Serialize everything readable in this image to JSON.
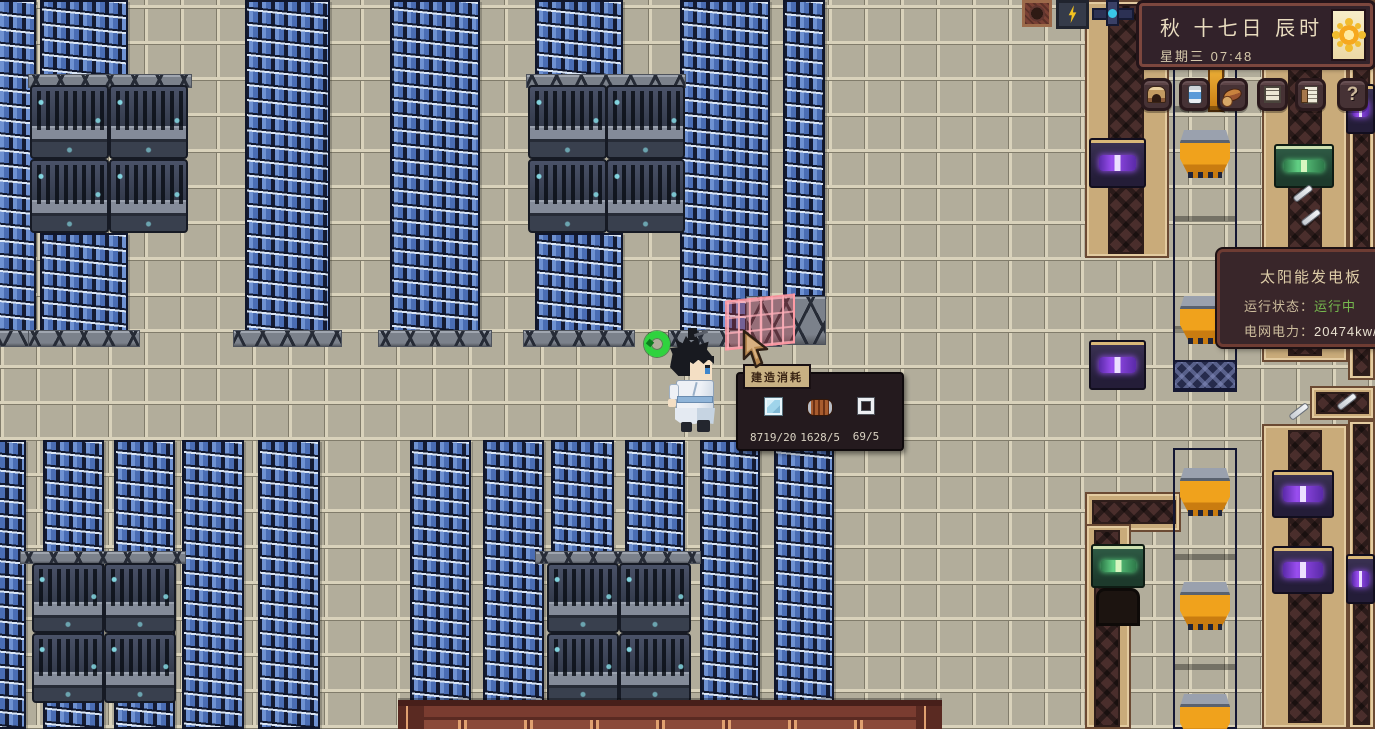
{
  "game_hud": {
    "date_panel": {
      "date_line": "秋 十七日 辰时",
      "weekday": "星期三",
      "time": "07:48",
      "weather_icon": "sun-icon"
    },
    "toolbar": {
      "items": [
        {
          "name": "home-button",
          "icon": "furnace-icon"
        },
        {
          "name": "storage-button",
          "icon": "canned-food-icon"
        },
        {
          "name": "food-button",
          "icon": "food-icon"
        },
        {
          "name": "tasks-button",
          "icon": "list-icon"
        },
        {
          "name": "ledger-button",
          "icon": "ledger-icon"
        },
        {
          "name": "help-button",
          "icon": "question-mark-icon",
          "glyph": "?"
        }
      ]
    },
    "solar_tooltip": {
      "title": "太阳能发电板",
      "rows": [
        {
          "label": "运行状态：",
          "value": "运行中"
        },
        {
          "label": "电网电力：",
          "value": "20474kw/s"
        }
      ]
    },
    "build_cost_panel": {
      "header": "建造消耗",
      "items": [
        {
          "icon": "glass-panel-icon",
          "count": "8719/20"
        },
        {
          "icon": "copper-coil-icon",
          "count": "1628/5"
        },
        {
          "icon": "frame-icon",
          "count": "69/5"
        }
      ]
    }
  },
  "world": {
    "visible_objects": [
      "solar-panel-array",
      "battery-machines",
      "conveyor-belts",
      "power-pipes",
      "pipe-hopper-machines",
      "splitter-machines",
      "processor-machines",
      "player-character",
      "placement-ghost-solar-panel",
      "power-status-ring",
      "building-roof",
      "metal-rod-items"
    ],
    "colors": {
      "floor_tan": "#b2ad9b",
      "panel_blue": "#4a6db4",
      "status_green": "#76b94e",
      "ui_dark_brown": "#32222a",
      "ui_frame_red": "#7c473e",
      "hopper_orange": "#f0a21c",
      "ghost_pink": "#ff96a0"
    }
  }
}
